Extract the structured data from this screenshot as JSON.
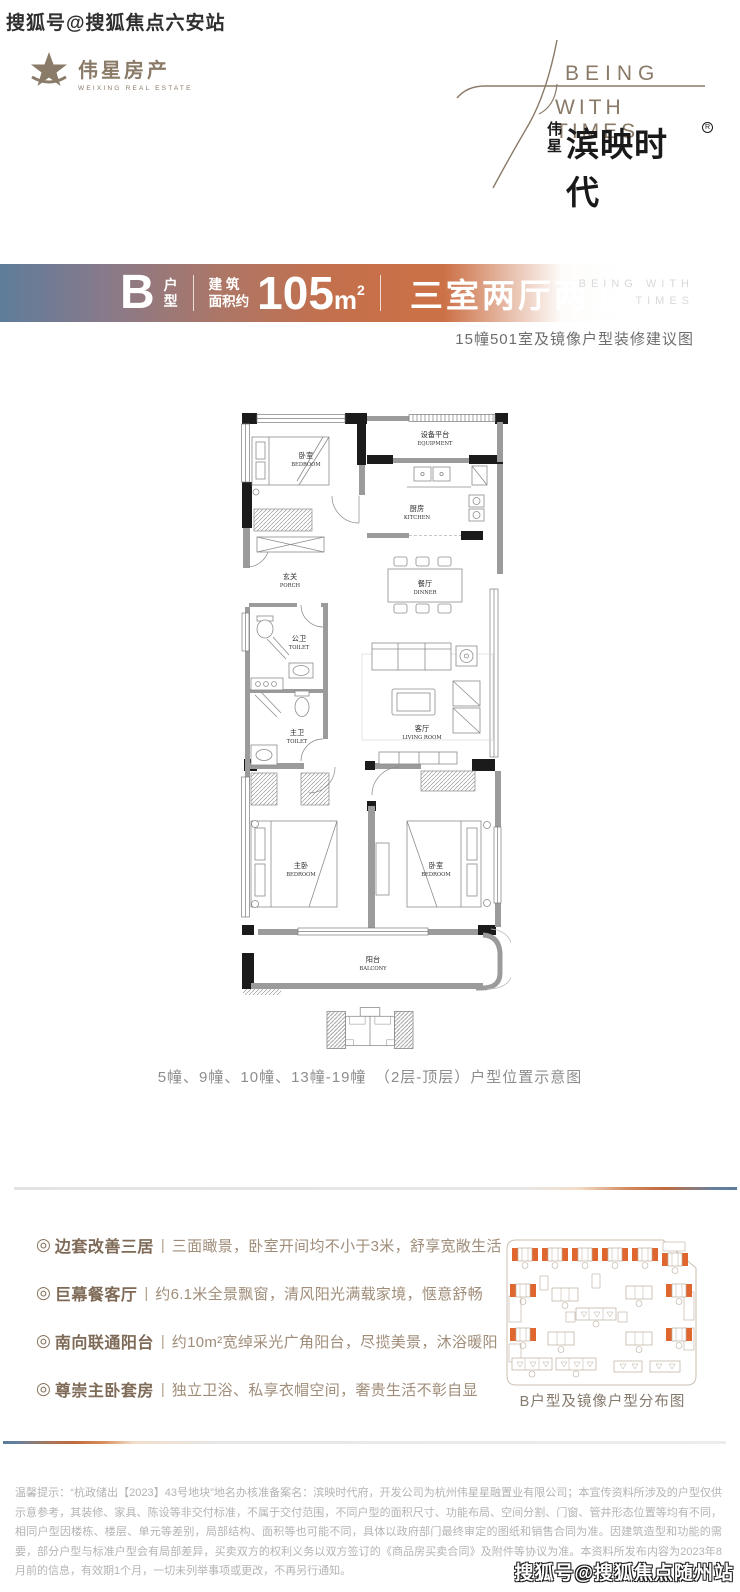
{
  "watermark_top": "搜狐号@搜狐焦点六安站",
  "watermark_bottom": "搜狐号@搜狐焦点随州站",
  "logo": {
    "cn": "伟星房产",
    "en": "WEIXING REAL ESTATE"
  },
  "brand": {
    "en1": "BEING",
    "en2": "WITH TIMES",
    "cn_v1": "伟",
    "cn_v2": "星",
    "cn_main": "滨映时代",
    "reg": "R"
  },
  "banner": {
    "type_letter": "B",
    "type_label_1": "户",
    "type_label_2": "型",
    "area_label_1": "建 筑",
    "area_label_2": "面积约",
    "area_value": "105",
    "area_unit": "m",
    "area_power": "2",
    "layout": "三室两厅两卫",
    "wm1": "BEING WITH",
    "wm2": "TIMES"
  },
  "subtitle": "15幢501室及镜像户型装修建议图",
  "floorplan": {
    "bedroom_top": {
      "cn": "卧室",
      "en": "BEDROOM"
    },
    "equipment": {
      "cn": "设备平台",
      "en": "EQUIPMENT"
    },
    "kitchen": {
      "cn": "厨房",
      "en": "KITCHEN"
    },
    "porch": {
      "cn": "玄关",
      "en": "PORCH"
    },
    "dinner": {
      "cn": "餐厅",
      "en": "DINNER"
    },
    "toilet_public": {
      "cn": "公卫",
      "en": "TOILET"
    },
    "toilet_master": {
      "cn": "主卫",
      "en": "TOILET"
    },
    "living": {
      "cn": "客厅",
      "en": "LIVING ROOM"
    },
    "bedroom_master": {
      "cn": "主卧",
      "en": "BEDROOM"
    },
    "bedroom_right": {
      "cn": "卧室",
      "en": "BEDROOM"
    },
    "balcony": {
      "cn": "阳台",
      "en": "BALCONY"
    }
  },
  "keyplan_caption": "5幢、9幢、10幢、13幢-19幢　（2层-顶层）户型位置示意图",
  "features_meta": {
    "bullet": "◎",
    "divider": "|"
  },
  "features": [
    {
      "title": "边套改善三居",
      "desc": "三面瞰景，卧室开间均不小于3米，舒享宽敞生活"
    },
    {
      "title": "巨幕餐客厅",
      "desc": "约6.1米全景飘窗，清风阳光满载家境，惬意舒畅"
    },
    {
      "title": "南向联通阳台",
      "desc": "约10m²宽绰采光广角阳台，尽揽美景，沐浴暖阳"
    },
    {
      "title": "尊崇主卧套房",
      "desc": "独立卫浴、私享衣帽空间，奢贵生活不彰自显"
    }
  ],
  "siteplan_caption": "B户型及镜像户型分布图",
  "disclaimer": "温馨提示：“杭政储出【2023】43号地块”地名办核准备案名：滨映时代府，开发公司为杭州伟星星融置业有限公司；本宣传资料所涉及的户型仅供示意参考，其装修、家具、陈设等非交付标准，不属于交付范围，不同户型的面积尺寸、功能布局、空间分割、门窗、管井形态位置等均有不同，相同户型因楼栋、楼层、单元等差别，局部结构、面积等也可能不同，具体以政府部门最终审定的图纸和销售合同为准。因建筑造型和功能的需要，部分户型与标准户型会有局部差异，买卖双方的权利义务以双方签订的《商品房买卖合同》及附件等协议为准。本资料所发布内容为2023年8月前的信息，有效期1个月，一切未列举事项或更改，不再另行通知。"
}
